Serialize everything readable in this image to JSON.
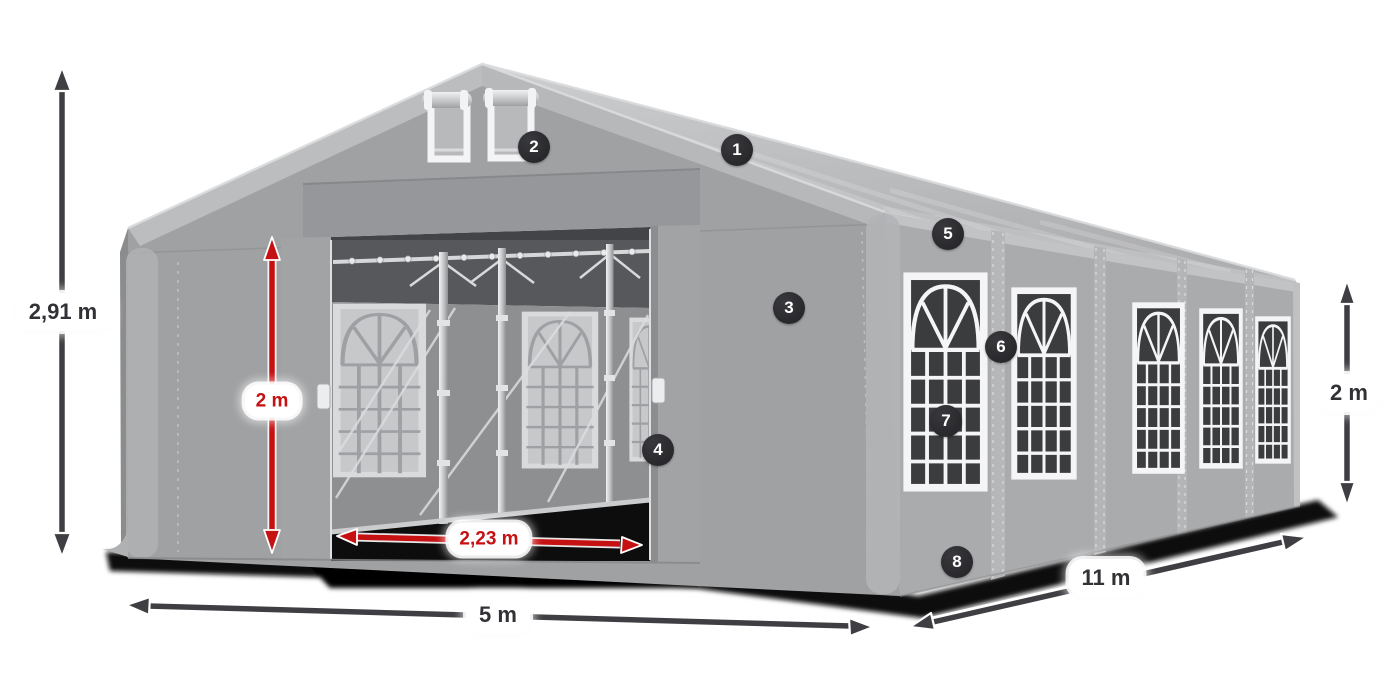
{
  "diagram": {
    "subject": "Party tent marquee with dimension annotations",
    "accent_red": "#c61113",
    "arrow_dark": "#3f3f43",
    "badge_bg": "#29292c",
    "badge_text_color": "#ffffff",
    "label_bg": "#ffffff",
    "label_text_color": "#323236"
  },
  "dimension_labels": {
    "total_height": "2,91 m",
    "entrance_height": "2 m",
    "entrance_width": "2,23 m",
    "front_width": "5 m",
    "side_length": "11 m",
    "side_wall_height": "2 m"
  },
  "callouts": [
    {
      "number": "1"
    },
    {
      "number": "2"
    },
    {
      "number": "3"
    },
    {
      "number": "4"
    },
    {
      "number": "5"
    },
    {
      "number": "6"
    },
    {
      "number": "7"
    },
    {
      "number": "8"
    }
  ]
}
